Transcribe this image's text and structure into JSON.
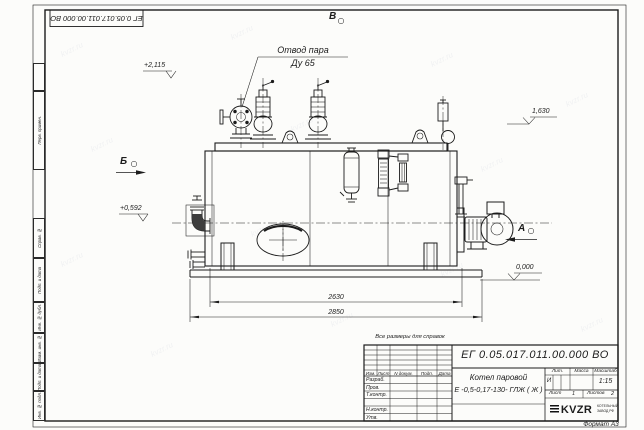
{
  "watermark": {
    "text": "kvzr.ru"
  },
  "margin": {
    "cells": [
      "Перв. примен.",
      "Справ. №",
      "Подп. и дата",
      "Инв. № дубл.",
      "Взам. инв. №",
      "Подп. и дата",
      "Инв. № подл."
    ]
  },
  "drawing": {
    "callout": {
      "line1": "Отвод пара",
      "line2": "Ду 65"
    },
    "views": {
      "top": "В",
      "left": "Б",
      "right": "А"
    },
    "levels": {
      "top": "+2,115",
      "mid": "+0,592",
      "right": "1,630",
      "zero": "0,000"
    },
    "dims": {
      "inner": "2630",
      "outer": "2850"
    }
  },
  "title_block": {
    "note": "Все размеры для справок",
    "designation": "ЕГ 0.05.017.011.00.000   ВО",
    "name_line1": "Котел паровой",
    "name_line2": "Е -0,5-0,17-130- ГЛЖ ( Ж )",
    "change_header": [
      "Изм.",
      "Лист",
      "N докум.",
      "Подп.",
      "Дата"
    ],
    "role_rows": [
      "Разраб.",
      "Пров.",
      "Т.контр.",
      "",
      "Н.контр.",
      "Утв."
    ],
    "lit_label": "Лит.",
    "lit_value": "И",
    "mass_label": "Масса",
    "scale_label": "Масштаб",
    "scale_value": "1:15",
    "sheet_label": "Лист",
    "sheet_value": "1",
    "sheets_label": "Листов",
    "sheets_value": "2",
    "logo_text": "KVZR",
    "logo_caption_1": "КОТЕЛЬНЫЙ",
    "logo_caption_2": "ЗАВОД РФ",
    "format": "Формат А3"
  }
}
